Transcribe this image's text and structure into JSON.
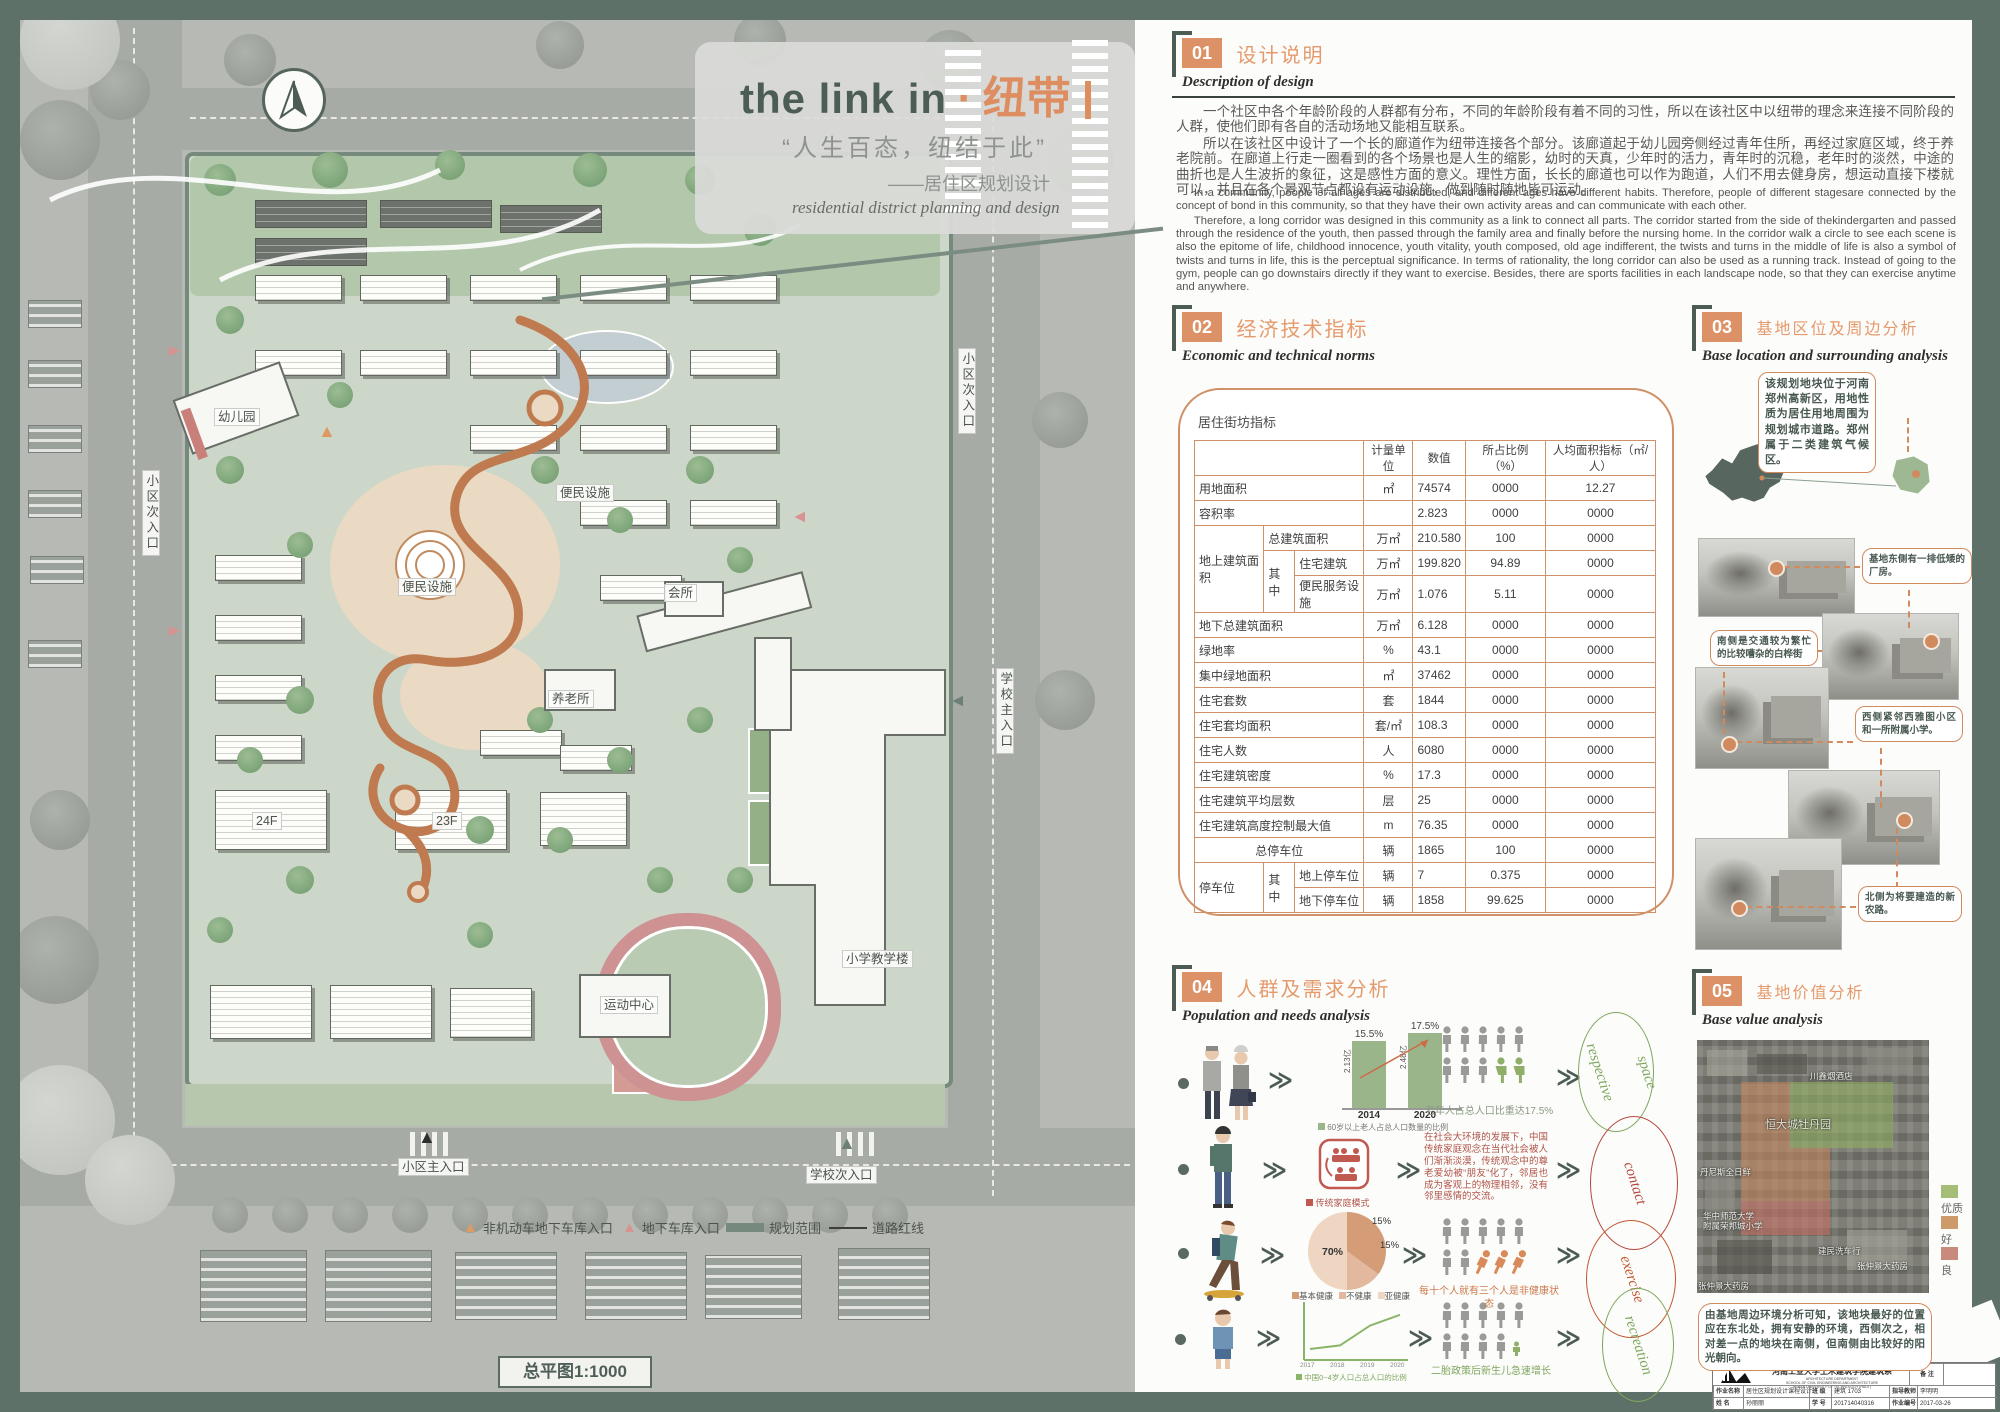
{
  "poster": {
    "title_en": "the link in",
    "title_sep": "·",
    "title_cn": "纽带",
    "quote": "“人生百态，纽结于此”",
    "subtitle_cn": "——居住区规划设计",
    "subtitle_en": "residential district planning and design"
  },
  "plan": {
    "scale_label": "总平图1:1000",
    "labels": [
      {
        "id": "side-entry-left",
        "t": "小区次入口"
      },
      {
        "id": "side-entry-top",
        "t": "小区次入口"
      },
      {
        "id": "school-main-entry",
        "t": "学校主入口"
      },
      {
        "id": "main-entry",
        "t": "小区主入口"
      },
      {
        "id": "school-side-entry",
        "t": "学校次入口"
      },
      {
        "id": "kindergarten",
        "t": "幼儿园"
      },
      {
        "id": "convenience-1",
        "t": "便民设施"
      },
      {
        "id": "convenience-2",
        "t": "便民设施"
      },
      {
        "id": "elderly-home",
        "t": "养老所"
      },
      {
        "id": "club",
        "t": "会所"
      },
      {
        "id": "school-building",
        "t": "小学教学楼"
      },
      {
        "id": "sports-center",
        "t": "运动中心"
      },
      {
        "id": "tower-24f",
        "t": "24F"
      },
      {
        "id": "tower-23f",
        "t": "23F"
      }
    ],
    "legend": [
      {
        "icon": "triangle-orange",
        "label": "非机动车地下车库入口"
      },
      {
        "icon": "triangle-pink",
        "label": "地下车库入口"
      },
      {
        "icon": "bar-teal",
        "label": "规划范围"
      },
      {
        "icon": "line-black",
        "label": "道路红线"
      }
    ]
  },
  "sections": {
    "s1": {
      "num": "01",
      "title_cn": "设计说明",
      "title_en": "Description of design",
      "cn1": "一个社区中各个年龄阶段的人群都有分布，不同的年龄阶段有着不同的习性，所以在该社区中以纽带的理念来连接不同阶段的人群，使他们即有各自的活动场地又能相互联系。",
      "cn2": "所以在该社区中设计了一个长的廊道作为纽带连接各个部分。该廊道起于幼儿园旁侧经过青年住所，再经过家庭区域，终于养老院前。在廊道上行走一圈看到的各个场景也是人生的缩影，幼时的天真，少年时的活力，青年时的沉稳，老年时的淡然，中途的曲折也是人生波折的象征，这是感性方面的意义。理性方面，长长的廊道也可以作为跑道，人们不用去健身房，想运动直接下楼就可以，并且在各个景观节点都设有运动设施，做到随时随地皆可运动。",
      "en1": "In a community, people of all ages are distributed, and different ages have different habits. Therefore, people of different stagesare connected by the concept of bond in this community, so that they have their own activity areas and can communicate with each other.",
      "en2": "Therefore, a long corridor was designed in this community as a link to connect all parts. The corridor started from the side of thekindergarten and passed through the residence of the youth, then passed through the family area and finally before the nursing home. In the corridor walk a circle to see each scene is also the epitome of life, childhood innocence, youth vitality, youth composed, old age indifferent, the twists and turns in the middle of life is also a symbol of twists and turns in life, this is the perceptual significance. In terms of rationality, the long corridor can also be used as a running track. Instead of going to the gym, people can go downstairs directly if they want to exercise. Besides, there are sports facilities in each landscape node, so that they can exercise anytime and anywhere."
    },
    "s2": {
      "num": "02",
      "title_cn": "经济技术指标",
      "title_en": "Economic and technical norms",
      "table_caption": "居住街坊指标",
      "header": [
        "",
        "计量单位",
        "数值",
        "所占比例（%）",
        "人均面积指标（㎡/人）"
      ],
      "rows": [
        {
          "cells": [
            {
              "t": "用地面积",
              "cs": 3
            },
            {
              "t": "㎡",
              "c": 1
            },
            {
              "t": "74574"
            },
            {
              "t": "0000",
              "c": 1
            },
            {
              "t": "12.27",
              "c": 1
            }
          ]
        },
        {
          "cells": [
            {
              "t": "容积率",
              "cs": 3
            },
            {
              "t": "",
              "c": 1
            },
            {
              "t": "2.823"
            },
            {
              "t": "0000",
              "c": 1
            },
            {
              "t": "0000",
              "c": 1
            }
          ]
        },
        {
          "cells": [
            {
              "t": "地上建筑面积",
              "rs": 3
            },
            {
              "t": "总建筑面积",
              "cs": 2
            },
            {
              "t": "万㎡",
              "c": 1
            },
            {
              "t": "210.580"
            },
            {
              "t": "100",
              "c": 1
            },
            {
              "t": "0000",
              "c": 1
            }
          ]
        },
        {
          "cells": [
            {
              "t": "其中",
              "rs": 2
            },
            {
              "t": "住宅建筑"
            },
            {
              "t": "万㎡",
              "c": 1
            },
            {
              "t": "199.820"
            },
            {
              "t": "94.89",
              "c": 1
            },
            {
              "t": "0000",
              "c": 1
            }
          ]
        },
        {
          "cells": [
            {
              "t": "便民服务设施"
            },
            {
              "t": "万㎡",
              "c": 1
            },
            {
              "t": "1.076"
            },
            {
              "t": "5.11",
              "c": 1
            },
            {
              "t": "0000",
              "c": 1
            }
          ]
        },
        {
          "cells": [
            {
              "t": "地下总建筑面积",
              "cs": 3
            },
            {
              "t": "万㎡",
              "c": 1
            },
            {
              "t": "6.128"
            },
            {
              "t": "0000",
              "c": 1
            },
            {
              "t": "0000",
              "c": 1
            }
          ]
        },
        {
          "cells": [
            {
              "t": "绿地率",
              "cs": 3
            },
            {
              "t": "%",
              "c": 1
            },
            {
              "t": "43.1"
            },
            {
              "t": "0000",
              "c": 1
            },
            {
              "t": "0000",
              "c": 1
            }
          ]
        },
        {
          "cells": [
            {
              "t": "集中绿地面积",
              "cs": 3
            },
            {
              "t": "㎡",
              "c": 1
            },
            {
              "t": "37462"
            },
            {
              "t": "0000",
              "c": 1
            },
            {
              "t": "0000",
              "c": 1
            }
          ]
        },
        {
          "cells": [
            {
              "t": "住宅套数",
              "cs": 3
            },
            {
              "t": "套",
              "c": 1
            },
            {
              "t": "1844"
            },
            {
              "t": "0000",
              "c": 1
            },
            {
              "t": "0000",
              "c": 1
            }
          ]
        },
        {
          "cells": [
            {
              "t": "住宅套均面积",
              "cs": 3
            },
            {
              "t": "套/㎡",
              "c": 1
            },
            {
              "t": "108.3"
            },
            {
              "t": "0000",
              "c": 1
            },
            {
              "t": "0000",
              "c": 1
            }
          ]
        },
        {
          "cells": [
            {
              "t": "住宅人数",
              "cs": 3
            },
            {
              "t": "人",
              "c": 1
            },
            {
              "t": "6080"
            },
            {
              "t": "0000",
              "c": 1
            },
            {
              "t": "0000",
              "c": 1
            }
          ]
        },
        {
          "cells": [
            {
              "t": "住宅建筑密度",
              "cs": 3
            },
            {
              "t": "%",
              "c": 1
            },
            {
              "t": "17.3"
            },
            {
              "t": "0000",
              "c": 1
            },
            {
              "t": "0000",
              "c": 1
            }
          ]
        },
        {
          "cells": [
            {
              "t": "住宅建筑平均层数",
              "cs": 3
            },
            {
              "t": "层",
              "c": 1
            },
            {
              "t": "25"
            },
            {
              "t": "0000",
              "c": 1
            },
            {
              "t": "0000",
              "c": 1
            }
          ]
        },
        {
          "cells": [
            {
              "t": "住宅建筑高度控制最大值",
              "cs": 3
            },
            {
              "t": "m",
              "c": 1
            },
            {
              "t": "76.35"
            },
            {
              "t": "0000",
              "c": 1
            },
            {
              "t": "0000",
              "c": 1
            }
          ]
        },
        {
          "cells": [
            {
              "t": "总停车位",
              "cs": 3,
              "c": 1
            },
            {
              "t": "辆",
              "c": 1
            },
            {
              "t": "1865"
            },
            {
              "t": "100",
              "c": 1
            },
            {
              "t": "0000",
              "c": 1
            }
          ]
        },
        {
          "cells": [
            {
              "t": "停车位",
              "rs": 2
            },
            {
              "t": "其中",
              "rs": 2
            },
            {
              "t": "地上停车位"
            },
            {
              "t": "辆",
              "c": 1
            },
            {
              "t": "7"
            },
            {
              "t": "0.375",
              "c": 1
            },
            {
              "t": "0000",
              "c": 1
            }
          ]
        },
        {
          "cells": [
            {
              "t": "地下停车位"
            },
            {
              "t": "辆",
              "c": 1
            },
            {
              "t": "1858"
            },
            {
              "t": "99.625",
              "c": 1
            },
            {
              "t": "0000",
              "c": 1
            }
          ]
        }
      ]
    },
    "s3": {
      "num": "03",
      "title_cn": "基地区位及周边分析",
      "title_en": "Base location and surrounding analysis",
      "intro_callout": "该规划地块位于河南郑州高新区，用地性质为居住用地周围为规划城市道路。郑州属于二类建筑气候区。",
      "callouts": [
        "基地东侧有一排低矮的厂房。",
        "南侧是交通较为繁忙的比较嘈杂的白桦街",
        "西侧紧邻西雅图小区和一所附属小学。",
        "北侧为将要建造的新农路。"
      ]
    },
    "s4": {
      "num": "04",
      "title_cn": "人群及需求分析",
      "title_en": "Population and needs analysis",
      "rows": [
        {
          "caption": "老年人占总人口比重达17.5%"
        },
        {
          "legend": "传统家庭模式",
          "text": "在社会大环境的发展下，中国传统家庭观念在当代社会被人们渐渐淡漠，传统观念中的尊老爱幼被“朋友”化了，邻居也成为客观上的物理相邻，没有邻里感情的交流。"
        },
        {
          "caption": "每十个人就有三个人是非健康状态"
        },
        {
          "caption": "二胎政策后新生儿急速增长",
          "legend": "中国0~4岁人口占总人口的比例"
        }
      ],
      "ellipses": [
        "respective space",
        "contact",
        "exercise",
        "recreation"
      ]
    },
    "s5": {
      "num": "05",
      "title_cn": "基地价值分析",
      "title_en": "Base value analysis",
      "legend": [
        {
          "label": "优质",
          "color": "#a5bd77"
        },
        {
          "label": "好",
          "color": "#cd9a6a"
        },
        {
          "label": "良",
          "color": "#c98a7e"
        }
      ],
      "map_labels": [
        "川鑫烟酒店",
        "恒大城牡丹园",
        "丹尼斯全日鲜",
        "华中师范大学",
        "附属荣邦城小学",
        "建民洗车行",
        "张仲景大药房",
        "张仲景大药房"
      ],
      "caption": "由基地周边环境分析可知，该地块最好的位置应在东北处，拥有安静的环境，西侧次之，相对差一点的地块在南侧，但南侧由比较好的阳光朝向。"
    }
  },
  "chart_data": [
    {
      "type": "bar",
      "title": "60岁以上老人占总人口数量的比例",
      "categories": [
        "2014",
        "2020"
      ],
      "values": [
        15.5,
        17.5
      ],
      "value_labels": [
        "15.5%",
        "17.5%"
      ],
      "bar_annotations": [
        "2.13亿",
        "2.48亿"
      ],
      "ylim": [
        0,
        20
      ],
      "color": "#9bb58a"
    },
    {
      "type": "pie",
      "labels": [
        "基本健康",
        "不健康",
        "亚健康"
      ],
      "values": [
        70,
        15,
        15
      ],
      "value_labels": [
        "70%",
        "15%",
        "15%"
      ],
      "colors": [
        "#d49d78",
        "#e2b99e",
        "#efd6c3"
      ]
    },
    {
      "type": "line",
      "title": "中国0~4岁人口占总人口的比例",
      "x": [
        "2017",
        "2018",
        "2019",
        "2020"
      ],
      "y": [
        4.0,
        4.2,
        5.3,
        5.9
      ],
      "note": "values estimated from unlabeled axis",
      "color": "#8ab568"
    }
  ],
  "titleblock": {
    "school_cn": "河南工业大学土木建筑学院建筑系",
    "dept_en": "ARCHITECTURE DEPARTMENT",
    "school_en": "SCHOOL OF CIVIL ENGINEERING AND ARCHITECTURE",
    "univ_en": "HENAN UNIVERSITY OF TECHNOLOGY (HAUT)",
    "remark_label": "备  注",
    "rows": [
      [
        {
          "k": "作业名称",
          "v": "居住区规划设计课程设计"
        },
        {
          "k": "班  级",
          "v": "建筑 1703"
        },
        {
          "k": "指导教师",
          "v": "李明明"
        }
      ],
      [
        {
          "k": "姓  名",
          "v": "孙丽丽"
        },
        {
          "k": "学  号",
          "v": "201714040316"
        },
        {
          "k": "作业编号",
          "v": "2017-03-26"
        }
      ]
    ]
  }
}
